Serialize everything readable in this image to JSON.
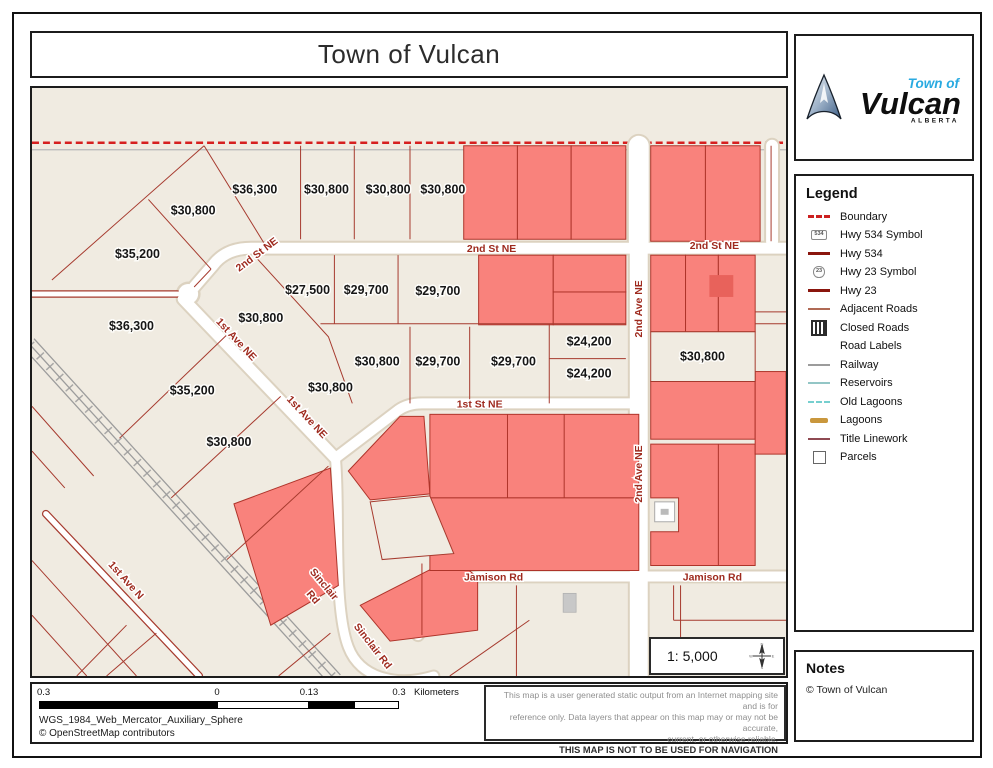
{
  "page": {
    "title": "Town of Vulcan"
  },
  "logo": {
    "line1": "Town of",
    "line2": "Vulcan",
    "line3": "ALBERTA"
  },
  "legend": {
    "heading": "Legend",
    "items": [
      {
        "label": "Boundary",
        "icon": "boundary"
      },
      {
        "label": "Hwy 534 Symbol",
        "icon": "hwy534-symbol",
        "badge": "534"
      },
      {
        "label": "Hwy 534",
        "icon": "hwy534"
      },
      {
        "label": "Hwy 23 Symbol",
        "icon": "hwy23-symbol",
        "badge": "23"
      },
      {
        "label": "Hwy 23",
        "icon": "hwy23"
      },
      {
        "label": "Adjacent Roads",
        "icon": "adjacent-roads"
      },
      {
        "label": "Closed Roads",
        "icon": "closed-roads"
      },
      {
        "label": "Road Labels",
        "icon": "road-labels"
      },
      {
        "label": "Railway",
        "icon": "railway"
      },
      {
        "label": "Reservoirs",
        "icon": "reservoirs"
      },
      {
        "label": "Old Lagoons",
        "icon": "old-lagoons"
      },
      {
        "label": "Lagoons",
        "icon": "lagoons"
      },
      {
        "label": "Title Linework",
        "icon": "title-linework"
      },
      {
        "label": "Parcels",
        "icon": "parcels"
      }
    ]
  },
  "notes": {
    "heading": "Notes",
    "body": "© Town of Vulcan"
  },
  "scale_box": {
    "text": "1: 5,000"
  },
  "scalebar": {
    "labels": [
      "0.3",
      "0",
      "0.13",
      "0.3"
    ],
    "unit": "Kilometers"
  },
  "footer": {
    "projection": "WGS_1984_Web_Mercator_Auxiliary_Sphere",
    "attribution": "© OpenStreetMap contributors"
  },
  "disclaimer": {
    "lines": [
      "This map is a user generated static output from an Internet mapping site and is for",
      "reference only. Data layers that appear on this map may or may not be accurate,",
      "current, or otherwise reliable."
    ],
    "bold_line": "THIS MAP IS NOT TO BE USED FOR NAVIGATION"
  },
  "map": {
    "colors": {
      "background": "#f0ebe1",
      "parcel_red_fill": "#f9827c",
      "parcel_line": "#a63a2e",
      "boundary_red": "#d61f1f",
      "street_label": "#9e2a1e",
      "railway_gray": "#9c9c9c"
    },
    "street_labels": [
      {
        "text": "2nd St NE",
        "x": 228,
        "y": 170,
        "rot": -37
      },
      {
        "text": "2nd St NE",
        "x": 462,
        "y": 165,
        "rot": 0
      },
      {
        "text": "2nd St NE",
        "x": 686,
        "y": 162,
        "rot": 0
      },
      {
        "text": "1st Ave NE",
        "x": 203,
        "y": 255,
        "rot": 47
      },
      {
        "text": "1st Ave NE",
        "x": 274,
        "y": 333,
        "rot": 47
      },
      {
        "text": "1st St NE",
        "x": 450,
        "y": 321,
        "rot": 0
      },
      {
        "text": "2nd Ave NE",
        "x": 613,
        "y": 222,
        "rot": -90
      },
      {
        "text": "2nd Ave NE",
        "x": 613,
        "y": 388,
        "rot": -90
      },
      {
        "text": "Jamison Rd",
        "x": 464,
        "y": 495,
        "rot": 0
      },
      {
        "text": "Jamison Rd",
        "x": 684,
        "y": 495,
        "rot": 0
      },
      {
        "text": "Sinclair",
        "x": 291,
        "y": 501,
        "rot": 50
      },
      {
        "text": "Rd",
        "x": 280,
        "y": 514,
        "rot": 50
      },
      {
        "text": "Sinclair Rd",
        "x": 340,
        "y": 563,
        "rot": 52
      },
      {
        "text": "1st Ave N",
        "x": 92,
        "y": 497,
        "rot": 48
      }
    ],
    "price_labels": [
      {
        "text": "$36,300",
        "x": 224,
        "y": 106
      },
      {
        "text": "$30,800",
        "x": 162,
        "y": 127
      },
      {
        "text": "$35,200",
        "x": 106,
        "y": 171
      },
      {
        "text": "$30,800",
        "x": 296,
        "y": 106
      },
      {
        "text": "$30,800",
        "x": 358,
        "y": 106
      },
      {
        "text": "$30,800",
        "x": 413,
        "y": 106
      },
      {
        "text": "$27,500",
        "x": 277,
        "y": 207
      },
      {
        "text": "$29,700",
        "x": 336,
        "y": 207
      },
      {
        "text": "$29,700",
        "x": 408,
        "y": 208
      },
      {
        "text": "$36,300",
        "x": 100,
        "y": 243
      },
      {
        "text": "$30,800",
        "x": 230,
        "y": 235
      },
      {
        "text": "$30,800",
        "x": 347,
        "y": 279
      },
      {
        "text": "$29,700",
        "x": 408,
        "y": 279
      },
      {
        "text": "$29,700",
        "x": 484,
        "y": 279
      },
      {
        "text": "$24,200",
        "x": 560,
        "y": 259
      },
      {
        "text": "$24,200",
        "x": 560,
        "y": 291
      },
      {
        "text": "$35,200",
        "x": 161,
        "y": 308
      },
      {
        "text": "$30,800",
        "x": 300,
        "y": 305
      },
      {
        "text": "$30,800",
        "x": 198,
        "y": 360
      },
      {
        "text": "$30,800",
        "x": 674,
        "y": 274
      }
    ]
  }
}
